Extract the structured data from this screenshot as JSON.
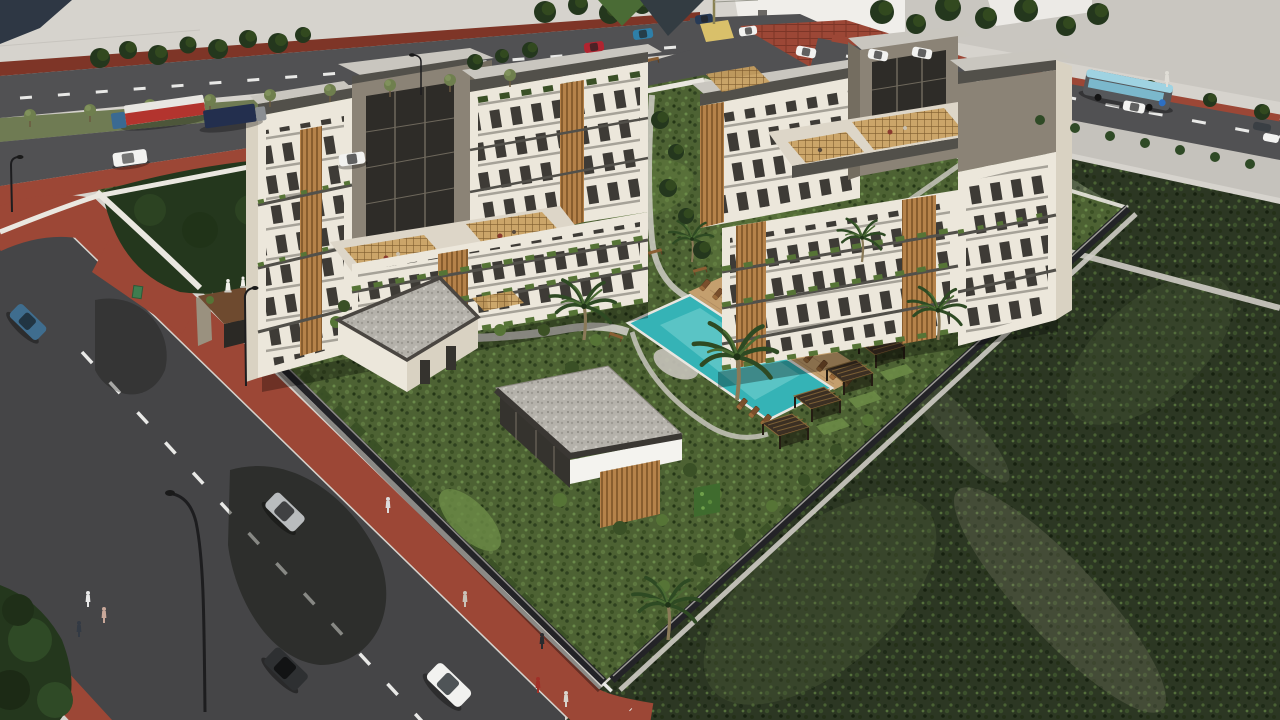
{
  "scene": {
    "type": "architectural-render",
    "view": "aerial-oblique",
    "description": "Aerial 3D architectural rendering of a gated residential complex: two mid-rise apartment clusters with rooftop pergola terraces and wood-slat facades, two modern flat-roof villas, a turquoise swimming pool with sun loungers and wooden cabanas, landscaped gardens with palm trees and white statues, a corten-steel entrance gate, surrounded by asphalt roads with red brick sidewalks, cars, trucks, a city bus, pedestrians and large empty green fields"
  },
  "site": {
    "apartment_clusters": 2,
    "villas": 2,
    "pools": 1,
    "cabanas": 4,
    "sun_loungers": 16,
    "rooftop_pergolas": 6,
    "statues": 4,
    "palm_trees": 6,
    "entrances": 1
  },
  "traffic": {
    "buses": 1,
    "trucks": 2,
    "vans": 1,
    "cars": 15,
    "pedestrians": 9,
    "street_lamps": 4
  },
  "palette": {
    "base": "#d6d3cd",
    "wedge": "#2e3744",
    "asphalt": "#454547",
    "asphalt2": "#515153",
    "brick": "#9c4736",
    "brick_d": "#7e3527",
    "median": "#6f7b53",
    "field_d": "#2c3723",
    "field_l": "#57644a",
    "garden": "#4d6233",
    "lawn": "#6c8b46",
    "path": "#cfccc5",
    "wall": "#eae7e0",
    "fence": "#232327",
    "cream": "#ece7db",
    "cream_sh": "#d9d2c2",
    "taupe": "#8b8376",
    "taupe_d": "#746d60",
    "roof_sl": "#52504a",
    "roof_top": "#c9c6bf",
    "gravel": "#b4b1aa",
    "wood": "#b5824a",
    "wood_d": "#7c5327",
    "pergola": "#c9a05e",
    "glass": "#2e2c28",
    "plant": "#3a5026",
    "plant_l": "#567436",
    "pool": "#35b3b6",
    "pool_l": "#7fd6d4",
    "deck": "#c49f6e",
    "white": "#f4f3ef",
    "tree_d": "#24371d",
    "tree_m": "#2f4a26",
    "corten": "#6e4a2f",
    "stone": "#9a917f",
    "lane": "#e9e9e7",
    "bus_roof": "#9fd3e2",
    "bus_body": "#55575a",
    "bus_win": "#7fc3d8",
    "truck_red": "#b3342e",
    "truck_navy": "#232f4e",
    "car_red": "#b02430",
    "car_teal": "#2e7fa8",
    "car_navy": "#273a56",
    "car_blue": "#3f6d8e",
    "car_silver": "#b9bcbe",
    "car_dark": "#2e3032",
    "car_white": "#f2f2f0"
  }
}
